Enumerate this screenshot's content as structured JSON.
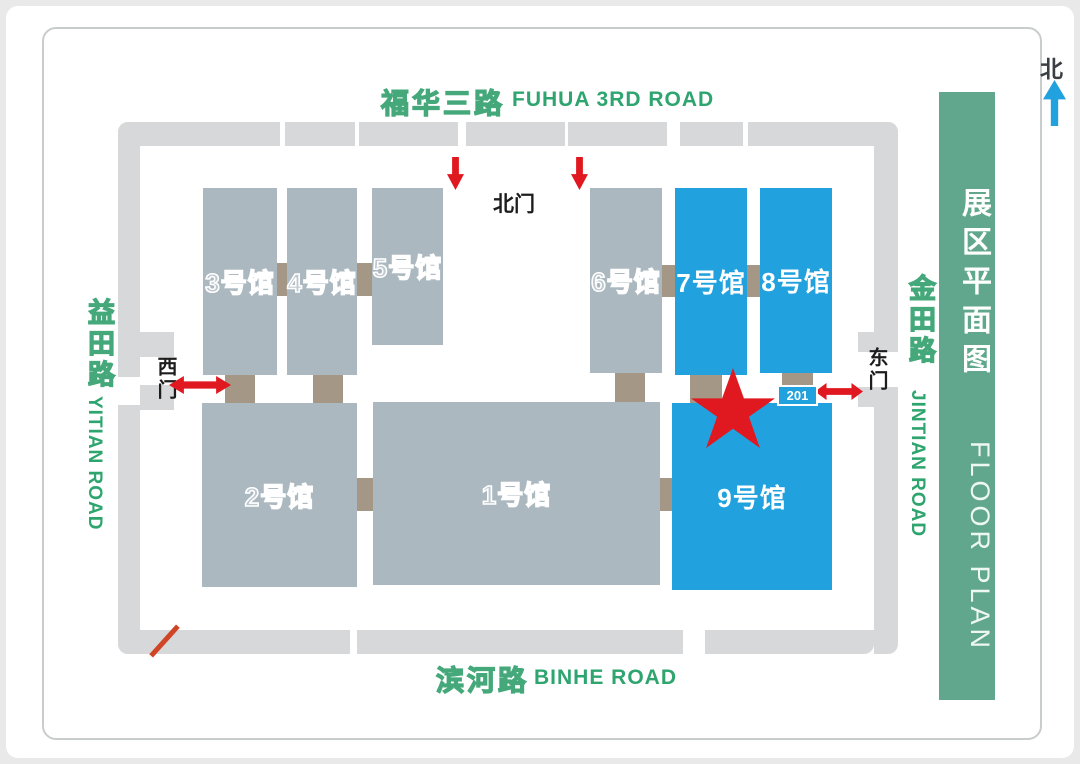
{
  "map_title": {
    "cn": "展区平面图",
    "en": "FLOOR PLAN"
  },
  "north_indicator": {
    "label": "北"
  },
  "roads": {
    "top": {
      "cn": "福华三路",
      "en": "FUHUA 3RD ROAD"
    },
    "bottom": {
      "cn": "滨河路",
      "en": "BINHE ROAD"
    },
    "left": {
      "cn": "益田路",
      "en": "YITIAN ROAD"
    },
    "right": {
      "cn": "金田路",
      "en": "JINTIAN ROAD"
    }
  },
  "gates": {
    "north": "北门",
    "west": "西门",
    "east": "东门"
  },
  "halls": [
    {
      "number": 1,
      "label": "1号馆",
      "highlighted": false
    },
    {
      "number": 2,
      "label": "2号馆",
      "highlighted": false
    },
    {
      "number": 3,
      "label": "3号馆",
      "highlighted": false
    },
    {
      "number": 4,
      "label": "4号馆",
      "highlighted": false
    },
    {
      "number": 5,
      "label": "5号馆",
      "highlighted": false
    },
    {
      "number": 6,
      "label": "6号馆",
      "highlighted": false
    },
    {
      "number": 7,
      "label": "7号馆",
      "highlighted": true
    },
    {
      "number": 8,
      "label": "8号馆",
      "highlighted": true
    },
    {
      "number": 9,
      "label": "9号馆",
      "highlighted": true
    }
  ],
  "location_badge": {
    "label": "201"
  },
  "colors": {
    "highlight_blue": "#21a1de",
    "hall_gray": "#abb8c0",
    "walkway_gray": "#d6d8d9",
    "connector_tan": "#a59786",
    "road_text_green": "#2ea56f",
    "title_bar_green": "#61a78d",
    "marker_red": "#e0181f"
  }
}
